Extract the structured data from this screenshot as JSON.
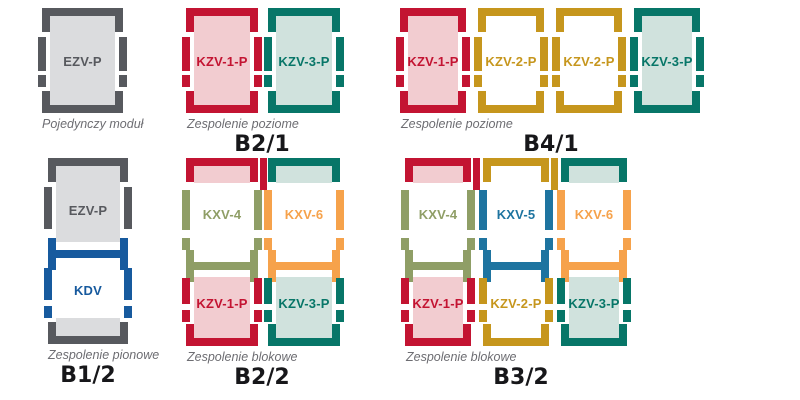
{
  "palette": {
    "red": "#c31432",
    "pink": "#f2ccd0",
    "teal": "#077668",
    "tealLight": "#d0e2dd",
    "gold": "#c6961d",
    "white": "#ffffff",
    "olive": "#8f9e66",
    "orange": "#f6a24b",
    "blue": "#1e74a0",
    "navy": "#175a9e",
    "gray": "#57595e",
    "grayLight": "#dbdcde",
    "caption_text": "#6d6d72",
    "title_text": "#17171a",
    "background": "#ffffff"
  },
  "groups": [
    {
      "id": "single",
      "caption": "Pojedynczy moduł",
      "title": "",
      "columns": [
        {
          "segments": [
            {
              "kind": "cap",
              "color": "gray",
              "tint": "grayLight"
            },
            {
              "kind": "body-full",
              "label": "EZV-P",
              "color": "gray",
              "tint": "grayLight"
            },
            {
              "kind": "tray",
              "color": "gray",
              "tint": "grayLight"
            }
          ]
        }
      ]
    },
    {
      "id": "b21",
      "caption": "Zespolenie poziome",
      "title": "B2/1",
      "columns": [
        {
          "segments": [
            {
              "kind": "cap",
              "color": "red",
              "tint": "pink"
            },
            {
              "kind": "body-full",
              "label": "KZV-1-P",
              "color": "red",
              "tint": "pink"
            },
            {
              "kind": "tray",
              "color": "red",
              "tint": "pink"
            }
          ]
        },
        {
          "segments": [
            {
              "kind": "cap",
              "color": "teal",
              "tint": "tealLight"
            },
            {
              "kind": "body-full",
              "label": "KZV-3-P",
              "color": "teal",
              "tint": "tealLight"
            },
            {
              "kind": "tray",
              "color": "teal",
              "tint": "tealLight"
            }
          ]
        }
      ]
    },
    {
      "id": "b41",
      "caption": "Zespolenie poziome",
      "title": "B4/1",
      "columns": [
        {
          "segments": [
            {
              "kind": "cap",
              "color": "red",
              "tint": "pink"
            },
            {
              "kind": "body-full",
              "label": "KZV-1-P",
              "color": "red",
              "tint": "pink"
            },
            {
              "kind": "tray",
              "color": "red",
              "tint": "pink"
            }
          ]
        },
        {
          "segments": [
            {
              "kind": "cap",
              "color": "gold",
              "tint": "white"
            },
            {
              "kind": "body-full",
              "label": "KZV-2-P",
              "color": "gold",
              "tint": "white"
            },
            {
              "kind": "tray",
              "color": "gold",
              "tint": "white"
            }
          ]
        },
        {
          "segments": [
            {
              "kind": "cap",
              "color": "gold",
              "tint": "white"
            },
            {
              "kind": "body-full",
              "label": "KZV-2-P",
              "color": "gold",
              "tint": "white"
            },
            {
              "kind": "tray",
              "color": "gold",
              "tint": "white"
            }
          ]
        },
        {
          "segments": [
            {
              "kind": "cap",
              "color": "teal",
              "tint": "tealLight"
            },
            {
              "kind": "body-full",
              "label": "KZV-3-P",
              "color": "teal",
              "tint": "tealLight"
            },
            {
              "kind": "tray",
              "color": "teal",
              "tint": "tealLight"
            }
          ]
        }
      ]
    },
    {
      "id": "b12",
      "caption": "Zespolenie pionowe",
      "title": "B1/2",
      "columns": [
        {
          "segments": [
            {
              "kind": "cap",
              "color": "gray",
              "tint": "grayLight"
            },
            {
              "kind": "body-top",
              "label": "EZV-P",
              "color": "gray",
              "tint": "grayLight"
            },
            {
              "kind": "conn",
              "color": "navy"
            },
            {
              "kind": "body-mid",
              "label": "KDV",
              "color": "navy",
              "tint": "white"
            },
            {
              "kind": "tray",
              "color": "gray",
              "tint": "grayLight"
            }
          ]
        }
      ]
    },
    {
      "id": "b22",
      "caption": "Zespolenie blokowe",
      "title": "B2/2",
      "columns": [
        {
          "segments": [
            {
              "kind": "cap",
              "color": "red",
              "tint": "pink"
            },
            {
              "kind": "body-kxv",
              "label": "KXV-4",
              "color": "olive",
              "tint": "white"
            },
            {
              "kind": "conn",
              "color": "olive"
            },
            {
              "kind": "body-base",
              "label": "KZV-1-P",
              "color": "red",
              "tint": "pink"
            },
            {
              "kind": "tray",
              "color": "red",
              "tint": "pink"
            }
          ]
        },
        {
          "segments": [
            {
              "kind": "cap",
              "color": "teal",
              "tint": "tealLight"
            },
            {
              "kind": "body-kxv",
              "label": "KXV-6",
              "color": "orange",
              "tint": "white"
            },
            {
              "kind": "conn",
              "color": "orange"
            },
            {
              "kind": "body-base",
              "label": "KZV-3-P",
              "color": "teal",
              "tint": "tealLight"
            },
            {
              "kind": "tray",
              "color": "teal",
              "tint": "tealLight"
            }
          ]
        }
      ]
    },
    {
      "id": "b32",
      "caption": "Zespolenie blokowe",
      "title": "B3/2",
      "columns": [
        {
          "segments": [
            {
              "kind": "cap",
              "color": "red",
              "tint": "pink"
            },
            {
              "kind": "body-kxv",
              "label": "KXV-4",
              "color": "olive",
              "tint": "white"
            },
            {
              "kind": "conn",
              "color": "olive"
            },
            {
              "kind": "body-base",
              "label": "KZV-1-P",
              "color": "red",
              "tint": "pink"
            },
            {
              "kind": "tray",
              "color": "red",
              "tint": "pink"
            }
          ]
        },
        {
          "segments": [
            {
              "kind": "cap",
              "color": "gold",
              "tint": "white"
            },
            {
              "kind": "body-kxv",
              "label": "KXV-5",
              "color": "blue",
              "tint": "white"
            },
            {
              "kind": "conn",
              "color": "blue"
            },
            {
              "kind": "body-base",
              "label": "KZV-2-P",
              "color": "gold",
              "tint": "white"
            },
            {
              "kind": "tray",
              "color": "gold",
              "tint": "white"
            }
          ]
        },
        {
          "segments": [
            {
              "kind": "cap",
              "color": "teal",
              "tint": "tealLight"
            },
            {
              "kind": "body-kxv",
              "label": "KXV-6",
              "color": "orange",
              "tint": "white"
            },
            {
              "kind": "conn",
              "color": "orange"
            },
            {
              "kind": "body-base",
              "label": "KZV-3-P",
              "color": "teal",
              "tint": "tealLight"
            },
            {
              "kind": "tray",
              "color": "teal",
              "tint": "tealLight"
            }
          ]
        }
      ]
    }
  ]
}
